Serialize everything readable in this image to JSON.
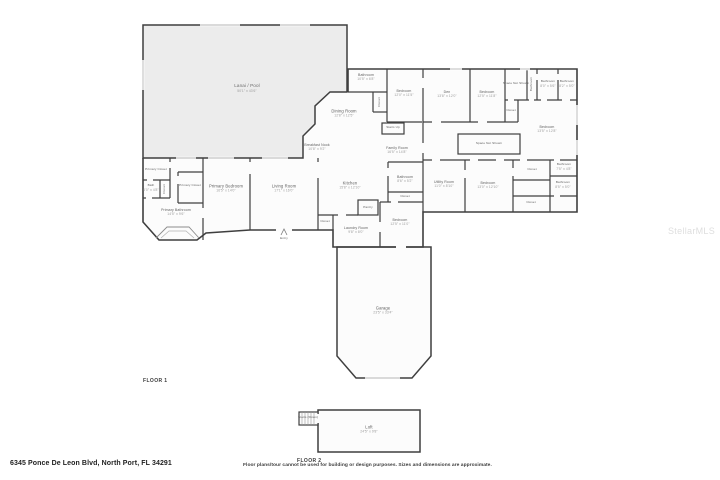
{
  "watermark": "StellarMLS",
  "footer": {
    "address": "6345 Ponce De Leon Blvd, North Port, FL 34291",
    "disclaimer": "Floor plans/tour cannot be used for building or design purposes. Sizes and dimensions are approximate."
  },
  "floors": [
    {
      "label": "FLOOR 1"
    },
    {
      "label": "FLOOR 2"
    }
  ],
  "colors": {
    "wall": "#3f3f3f",
    "lanai_fill": "#ececec",
    "room_fill": "#fcfcfc",
    "label_text": "#5e5e5e",
    "dims_text": "#9a9a9a",
    "watermark_text": "#dedede"
  },
  "rooms": [
    {
      "label": "Lanai / Pool",
      "dims": "50'1\" x 43'6\"",
      "x": 247,
      "y": 88,
      "style": "area"
    },
    {
      "label": "Breakfast Nook",
      "dims": "10'8\" x 9'2\"",
      "x": 317,
      "y": 147,
      "style": "small"
    },
    {
      "label": "Dining Room",
      "dims": "12'8\" x 12'5\"",
      "x": 344,
      "y": 113
    },
    {
      "label": "Bathroom",
      "dims": "10'5\" x 6'8\"",
      "x": 366,
      "y": 77,
      "style": "small"
    },
    {
      "label": "Closet",
      "x": 380,
      "y": 102,
      "style": "vertical tiny"
    },
    {
      "label": "Bedroom",
      "dims": "12'0\" x 11'5\"",
      "x": 404,
      "y": 93,
      "style": "small"
    },
    {
      "label": "Stairs Up",
      "x": 393,
      "y": 128,
      "style": "tiny"
    },
    {
      "label": "Family Room",
      "dims": "16'5\" x 14'8\"",
      "x": 397,
      "y": 150,
      "style": "small"
    },
    {
      "label": "Kitchen",
      "dims": "15'8\" x 12'10\"",
      "x": 350,
      "y": 185
    },
    {
      "label": "Pantry",
      "x": 368,
      "y": 208,
      "style": "tiny"
    },
    {
      "label": "Bathroom",
      "dims": "8'6\" x 5'2\"",
      "x": 405,
      "y": 179,
      "style": "small"
    },
    {
      "label": "Closet",
      "x": 405,
      "y": 197,
      "style": "tiny"
    },
    {
      "label": "Bedroom",
      "dims": "12'5\" x 11'0\"",
      "x": 400,
      "y": 222,
      "style": "small"
    },
    {
      "label": "Laundry Room",
      "dims": "9'8\" x 8'0\"",
      "x": 356,
      "y": 230,
      "style": "small"
    },
    {
      "label": "Closet",
      "x": 325,
      "y": 222,
      "style": "tiny"
    },
    {
      "label": "Living Room",
      "dims": "17'1\" x 16'0\"",
      "x": 284,
      "y": 188
    },
    {
      "label": "Primary Bedroom",
      "dims": "16'5\" x 14'0\"",
      "x": 226,
      "y": 188
    },
    {
      "label": "Primary Closet",
      "x": 156,
      "y": 170,
      "style": "tiny"
    },
    {
      "label": "Bath",
      "dims": "6'0\" x 4'8\"",
      "x": 151,
      "y": 188,
      "style": "tiny"
    },
    {
      "label": "Closet",
      "x": 165,
      "y": 189,
      "style": "vertical tiny"
    },
    {
      "label": "Primary Closet",
      "x": 190,
      "y": 186,
      "style": "tiny"
    },
    {
      "label": "Primary Bathroom",
      "dims": "14'5\" x 9'6\"",
      "x": 176,
      "y": 212,
      "style": "small"
    },
    {
      "label": "Entry",
      "x": 284,
      "y": 239,
      "style": "tiny"
    },
    {
      "label": "Garage",
      "dims": "23'5\" x 33'4\"",
      "x": 383,
      "y": 310
    },
    {
      "label": "Den",
      "dims": "13'8\" x 12'0\"",
      "x": 447,
      "y": 94,
      "style": "small"
    },
    {
      "label": "Bedroom",
      "dims": "12'5\" x 11'8\"",
      "x": 487,
      "y": 94,
      "style": "small"
    },
    {
      "label": "Space Not Shown",
      "x": 516,
      "y": 84,
      "style": "tiny"
    },
    {
      "label": "Bathroom",
      "x": 532,
      "y": 84,
      "style": "vertical tiny"
    },
    {
      "label": "Bathroom",
      "dims": "8'0\" x 5'6\"",
      "x": 548,
      "y": 84,
      "style": "tiny"
    },
    {
      "label": "Bathroom",
      "dims": "8'2\" x 5'0\"",
      "x": 567,
      "y": 84,
      "style": "tiny"
    },
    {
      "label": "Closet",
      "x": 511,
      "y": 111,
      "style": "tiny"
    },
    {
      "label": "Bedroom",
      "dims": "13'5\" x 12'8\"",
      "x": 547,
      "y": 129,
      "style": "small"
    },
    {
      "label": "Space Not Shown",
      "x": 489,
      "y": 144,
      "style": "tiny"
    },
    {
      "label": "Utility Room",
      "dims": "11'0\" x 8'10\"",
      "x": 444,
      "y": 184,
      "style": "small"
    },
    {
      "label": "Bedroom",
      "dims": "13'0\" x 12'10\"",
      "x": 488,
      "y": 185,
      "style": "small"
    },
    {
      "label": "Closet",
      "x": 532,
      "y": 170,
      "style": "tiny"
    },
    {
      "label": "Bathroom",
      "dims": "7'5\" x 4'8\"",
      "x": 564,
      "y": 167,
      "style": "tiny"
    },
    {
      "label": "Bathroom",
      "dims": "8'5\" x 5'0\"",
      "x": 563,
      "y": 185,
      "style": "tiny"
    },
    {
      "label": "Closet",
      "x": 531,
      "y": 203,
      "style": "tiny"
    },
    {
      "label": "Stairs (Down)",
      "x": 308,
      "y": 418,
      "style": "tiny"
    },
    {
      "label": "Loft",
      "dims": "24'5\" x 9'8\"",
      "x": 369,
      "y": 429
    }
  ]
}
